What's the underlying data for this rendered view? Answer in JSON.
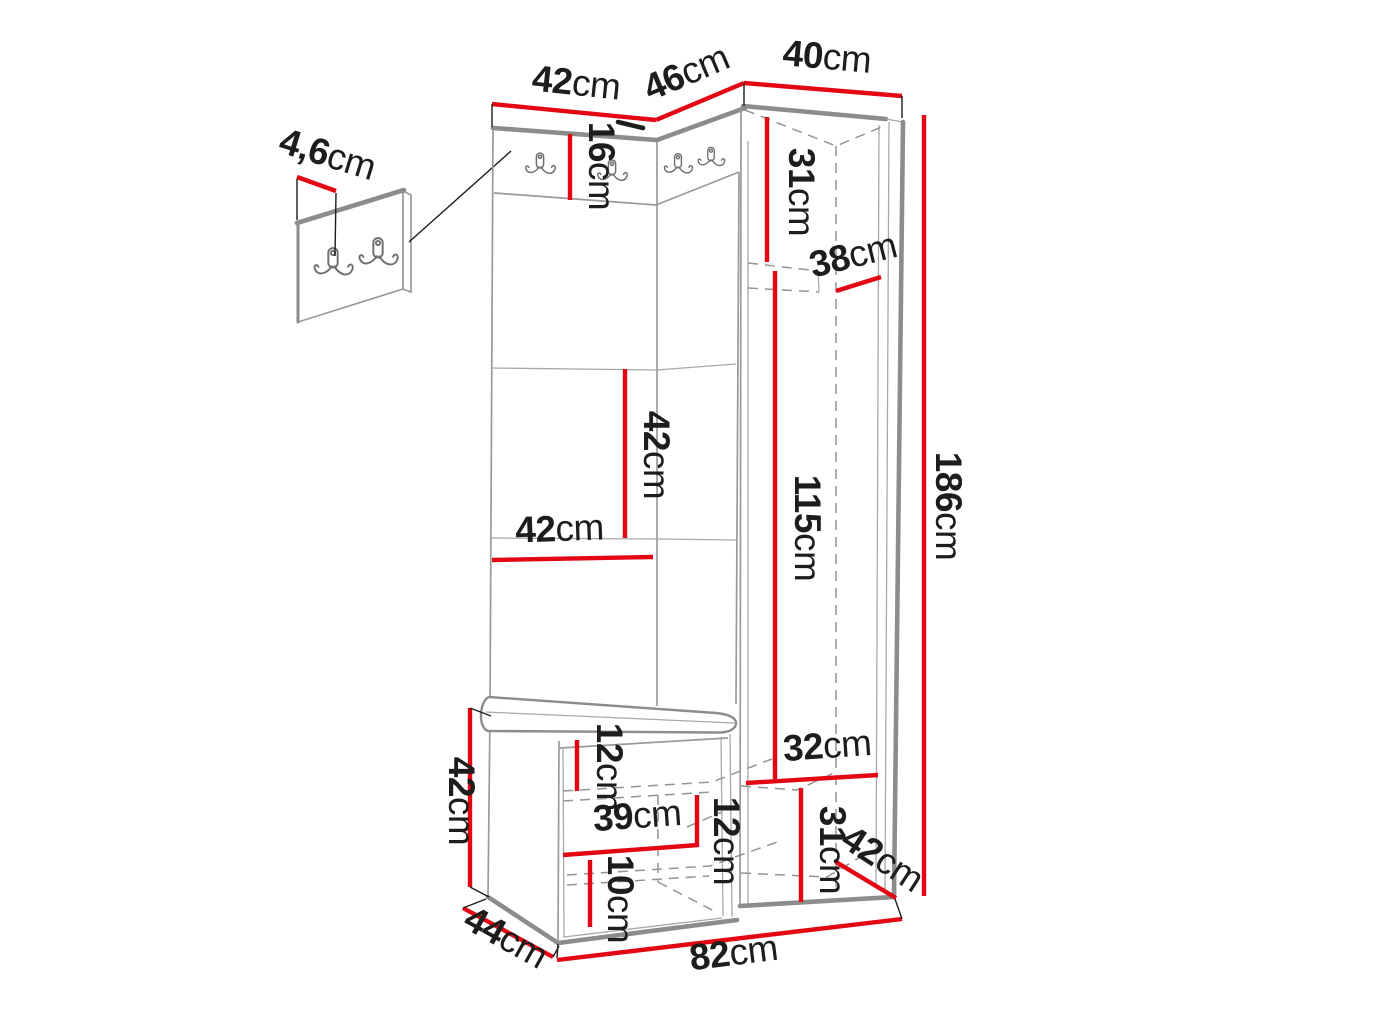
{
  "diagram": {
    "type": "furniture-dimension-drawing",
    "subject": "hallway wardrobe set with coat hooks, corner cabinet and shoe bench",
    "unit": "cm"
  },
  "colors": {
    "dimension_red": "#e30613",
    "furniture_gray": "#8c8c8c",
    "label_black": "#1d1d1b",
    "background": "#ffffff"
  },
  "icons": {
    "coat_hook": "double-coat-hook"
  },
  "dims": {
    "panel_left_width": {
      "value": "42",
      "unit": "cm"
    },
    "panel_mid_width": {
      "value": "46",
      "unit": "cm"
    },
    "cabinet_width": {
      "value": "40",
      "unit": "cm"
    },
    "hook_strip_height": {
      "value": "16",
      "unit": "cm"
    },
    "hook_panel_thickness": {
      "value": "4,6",
      "unit": "cm"
    },
    "cabinet_top_section_height": {
      "value": "31",
      "unit": "cm"
    },
    "cabinet_shelf_depth": {
      "value": "38",
      "unit": "cm"
    },
    "total_height": {
      "value": "186",
      "unit": "cm"
    },
    "panel_tile_height": {
      "value": "42",
      "unit": "cm"
    },
    "panel_tile_width": {
      "value": "42",
      "unit": "cm"
    },
    "hanging_section_height": {
      "value": "115",
      "unit": "cm"
    },
    "bench_height": {
      "value": "42",
      "unit": "cm"
    },
    "bench_depth": {
      "value": "44",
      "unit": "cm"
    },
    "bench_top_clearance": {
      "value": "12",
      "unit": "cm"
    },
    "bench_shelf_width": {
      "value": "39",
      "unit": "cm"
    },
    "bench_shelf_clearance": {
      "value": "12",
      "unit": "cm"
    },
    "bench_bottom_clearance": {
      "value": "10",
      "unit": "cm"
    },
    "base_width": {
      "value": "82",
      "unit": "cm"
    },
    "cabinet_bottom_shelf_width": {
      "value": "32",
      "unit": "cm"
    },
    "cabinet_bottom_section_height": {
      "value": "31",
      "unit": "cm"
    },
    "cabinet_depth": {
      "value": "42",
      "unit": "cm"
    }
  }
}
